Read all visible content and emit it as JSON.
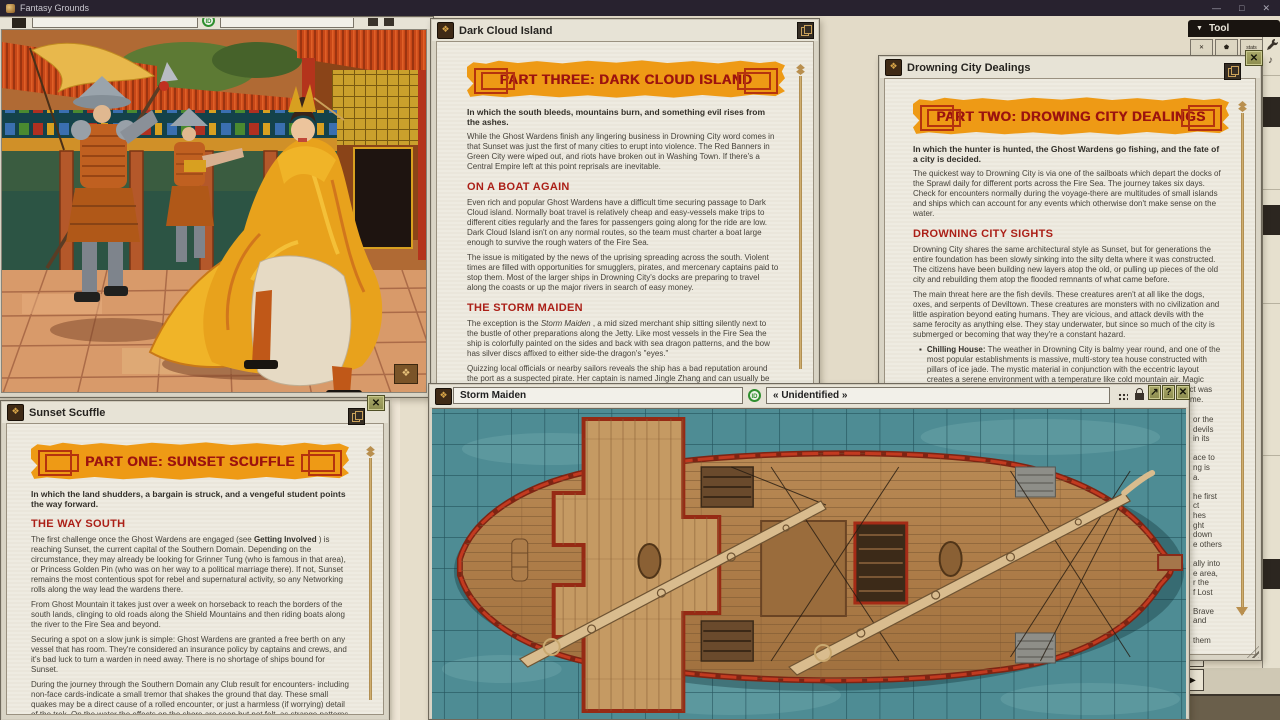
{
  "app": {
    "title": "Fantasy Grounds",
    "window_controls": {
      "minimize": "—",
      "maximize": "□",
      "close": "✕"
    }
  },
  "tool_panel": {
    "chevron": "▼",
    "label": "Tool",
    "partial_buttons": [
      "✕",
      "⬟",
      "stats"
    ],
    "music_note": "♪"
  },
  "icons": {
    "story_glyph": "❖",
    "bullet": "▪",
    "redo": "↷",
    "play": "▶",
    "id_badge": "ID"
  },
  "image_window": {
    "field_primary": "",
    "field_identity": ""
  },
  "dark_cloud": {
    "title": "Dark Cloud Island",
    "banner": "PART THREE: DARK CLOUD ISLAND",
    "intro": "In which the south bleeds, mountains burn, and something evil rises from the ashes.",
    "p1": "While the Ghost Wardens finish any lingering business in Drowning City word comes in that Sunset was just the first of many cities to erupt into violence. The Red Banners in Green City were wiped out, and riots have broken out in Washing Town. If there's a Central Empire left at this point reprisals are inevitable.",
    "h1": "ON A BOAT AGAIN",
    "p2": "Even rich and popular Ghost Wardens have a difficult time securing passage to Dark Cloud island. Normally boat travel is relatively cheap and easy-vessels make trips to different cities regularly and the fares for passengers going along for the ride are low. Dark Cloud Island isn't on any normal routes, so the team must charter a boat large enough to survive the rough waters of the Fire Sea.",
    "p3": "The issue is mitigated by the news of the uprising spreading across the south. Violent times are filled with opportunities for smugglers, pirates, and mercenary captains paid to stop them. Most of the larger ships in Drowning City's docks are preparing to travel along the coasts or up the major rivers in search of easy money.",
    "h2": "THE STORM MAIDEN",
    "p4_pre": "The exception is the ",
    "p4_ital": "Storm Maiden",
    "p4_post": " , a mid sized merchant ship sitting silently next to the bustle of other preparations along the Jetty. Like most vessels in the Fire Sea the ship is colorfully painted on the sides and back with sea dragon patterns, and the bow has silver discs affixed to either side-the dragon's \"eyes.\"",
    "p5": "Quizzing local officials or nearby sailors reveals the ship has a bad reputation around the port as a suspected pirate. Her captain is named Jingle Zhang and can usually be found in a gambling den not far from the Jetty. The rest of the crew scattered and haven't returned. No one knows why."
  },
  "drowning": {
    "title": "Drowning City Dealings",
    "banner": "PART TWO: DROWING CITY DEALINGS",
    "intro": "In which the hunter is hunted, the Ghost Wardens go fishing, and the fate of a city is decided.",
    "p1": "The quickest way to Drowning City is via one of the sailboats which depart the docks of the Sprawl daily for different ports across the Fire Sea. The journey takes six days. Check for encounters normally during the voyage-there are multitudes of small islands and ships which can account for any events which otherwise don't make sense on the water.",
    "h1": "DROWNING CITY SIGHTS",
    "p2": "Drowning City shares the same architectural style as Sunset, but for generations the entire foundation has been slowly sinking into the silty delta where it was constructed. The citizens have been building new layers atop the old, or pulling up pieces of the old city and rebuilding them atop the flooded remnants of what came before.",
    "p3": "The main threat here are the fish devils. These creatures aren't at all like the dogs, oxes, and serpents of Deviltown. These creatures are monsters with no civilization and little aspiration beyond eating humans. They are vicious, and attack devils with the same ferocity as anything else. They stay underwater, but since so much of the city is submerged or becoming that way they're a constant hazard.",
    "b1_bold": "Chilling House:",
    "b1_text": " The weather in Drowning City is balmy year round, and one of the most popular establishments is massive, multi-story tea house constructed with pillars of ice jade. The mystic material in conjunction with the eccentric layout creates a serene environment with a temperature like cold mountain air. Magic suppressed (-4 penalty) inside the structure, and spirits shun it. Which effect was intended and which is a side effect of the original design has been lost to time. Meals there are unsurprisingly expensive.",
    "clipped_lines": "or the\ndevils\nin its\n\nace to\nng is\na.\n\nhe first\nct\nhes\nght\ndown\ne others\n\nally into\ne area,\nr the\nf Lost\n\nBrave\nand\n\nthem",
    "close": "✕"
  },
  "sunset": {
    "title": "Sunset Scuffle",
    "banner": "PART ONE: SUNSET SCUFFLE",
    "intro": "In which the land shudders, a bargain is struck, and a vengeful student points the way forward.",
    "h1": "THE WAY SOUTH",
    "p1_pre": "The first challenge once the Ghost Wardens are engaged (see ",
    "p1_bold": "Getting Involved",
    "p1_post": " ) is reaching Sunset, the current capital of the Southern Domain. Depending on the circumstance, they may already be looking for Grinner Tung (who is famous in that area), or Princess Golden Pin (who was on her way to a political marriage there). If not, Sunset remains the most contentious spot for rebel and supernatural activity, so any Networking rolls along the way lead the wardens there.",
    "p2": "From Ghost Mountain it takes just over a week on horseback to reach the borders of the south lands, clinging to old roads along the Shield Mountains and then riding boats along the river to the Fire Sea and beyond.",
    "p3": "Securing a spot on a slow junk is simple: Ghost Wardens are granted a free berth on any vessel that has room. They're considered an insurance policy by captains and crews, and it's bad luck to turn a warden in need away. There is no shortage of ships bound for Sunset.",
    "p4": "During the journey through the Southern Domain any Club result for encounters- including non-face cards-indicate a small tremor that shakes the ground that day. These small quakes may be a direct cause of a rolled encounter, or just a harmless (if worrying) detail of the trek. On the water the effects on the shore are seen but not felt, as strange patterns in the sea water indicate some form of seismic activity below.",
    "h2": "SUNSET SIGHTS",
    "close": "✕"
  },
  "storm": {
    "title": "Storm Maiden",
    "identity": "« Unidentified »",
    "buttons": {
      "expand": "↗",
      "help": "?",
      "close": "✕"
    }
  }
}
